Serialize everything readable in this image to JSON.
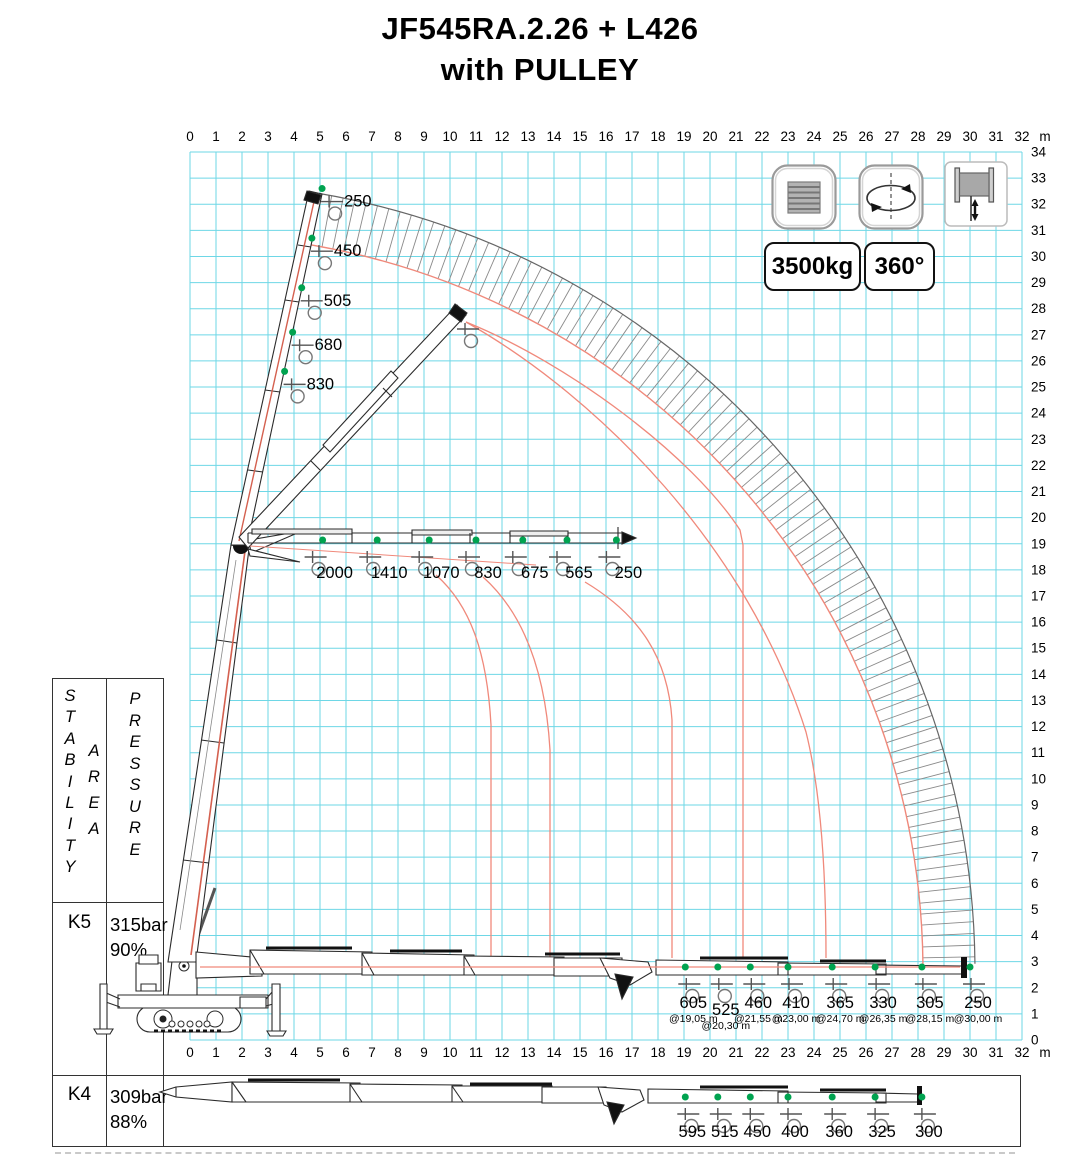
{
  "title": {
    "line1": "JF545RA.2.26 + L426",
    "line2": "with PULLEY"
  },
  "badges": {
    "capacity": "3500kg",
    "slew": "360°"
  },
  "icons": {
    "stabilizer": "stabilizer-pad-icon",
    "rotation": "rotation-360-icon",
    "winch": "winch-icon"
  },
  "colors": {
    "grid": "#6ed7e6",
    "hatch": "#8a8a8a",
    "arc_red": "#f0897b",
    "boom_red": "#d4604f",
    "green_dot": "#00a350",
    "ink": "#2b2b2b"
  },
  "axes": {
    "unit": "m",
    "x_ticks": [
      0,
      1,
      2,
      3,
      4,
      5,
      6,
      7,
      8,
      9,
      10,
      11,
      12,
      13,
      14,
      15,
      16,
      17,
      18,
      19,
      20,
      21,
      22,
      23,
      24,
      25,
      26,
      27,
      28,
      29,
      30,
      31,
      32
    ],
    "y_ticks": [
      0,
      1,
      2,
      3,
      4,
      5,
      6,
      7,
      8,
      9,
      10,
      11,
      12,
      13,
      14,
      15,
      16,
      17,
      18,
      19,
      20,
      21,
      22,
      23,
      24,
      25,
      26,
      27,
      28,
      29,
      30,
      31,
      32,
      33,
      34
    ]
  },
  "table": {
    "stability": "S\nT\nA\nB\nI\nL\nI\nT\nY",
    "area": "A\nR\nE\nA",
    "pressure": "P\nR\nE\nS\nS\nU\nR\nE",
    "rows": [
      {
        "key": "K5",
        "values": "315bar\n90%"
      },
      {
        "key": "K4",
        "values": "309bar\n88%"
      }
    ]
  },
  "chart_data": {
    "type": "crane-load-diagram",
    "x_axis": {
      "min": 0,
      "max": 32,
      "unit": "m"
    },
    "y_axis": {
      "min": 0,
      "max": 34
    },
    "vertical_jib_loads": [
      {
        "load": "250",
        "height_m": 32.6
      },
      {
        "load": "450",
        "height_m": 30.7
      },
      {
        "load": "505",
        "height_m": 28.8
      },
      {
        "load": "680",
        "height_m": 27.1
      },
      {
        "load": "830",
        "height_m": 25.6
      }
    ],
    "horizontal_jib_loads": [
      {
        "load": "2000",
        "radius_m": 5.1
      },
      {
        "load": "1410",
        "radius_m": 7.2
      },
      {
        "load": "1070",
        "radius_m": 9.2
      },
      {
        "load": "830",
        "radius_m": 11.0
      },
      {
        "load": "675",
        "radius_m": 12.8
      },
      {
        "load": "565",
        "radius_m": 14.5
      },
      {
        "load": "250",
        "radius_m": 16.4
      }
    ],
    "ground_loads_k5": [
      {
        "load": "605",
        "at": "@19,05 m",
        "radius_m": 19.05,
        "offset": false
      },
      {
        "load": "525",
        "at": "@20,30 m",
        "radius_m": 20.3,
        "offset": true
      },
      {
        "load": "460",
        "at": "@21,55 m",
        "radius_m": 21.55,
        "offset": false
      },
      {
        "load": "410",
        "at": "@23,00 m",
        "radius_m": 23.0,
        "offset": false
      },
      {
        "load": "365",
        "at": "@24,70 m",
        "radius_m": 24.7,
        "offset": false
      },
      {
        "load": "330",
        "at": "@26,35 m",
        "radius_m": 26.35,
        "offset": false
      },
      {
        "load": "305",
        "at": "@28,15 m",
        "radius_m": 28.15,
        "offset": false
      },
      {
        "load": "250",
        "at": "@30,00 m",
        "radius_m": 30.0,
        "offset": false
      }
    ],
    "ground_loads_k4": [
      {
        "load": "595",
        "radius_m": 19.05
      },
      {
        "load": "515",
        "radius_m": 20.3
      },
      {
        "load": "450",
        "radius_m": 21.55
      },
      {
        "load": "400",
        "radius_m": 23.0
      },
      {
        "load": "360",
        "radius_m": 24.7
      },
      {
        "load": "325",
        "radius_m": 26.35
      },
      {
        "load": "300",
        "radius_m": 28.15
      }
    ]
  }
}
